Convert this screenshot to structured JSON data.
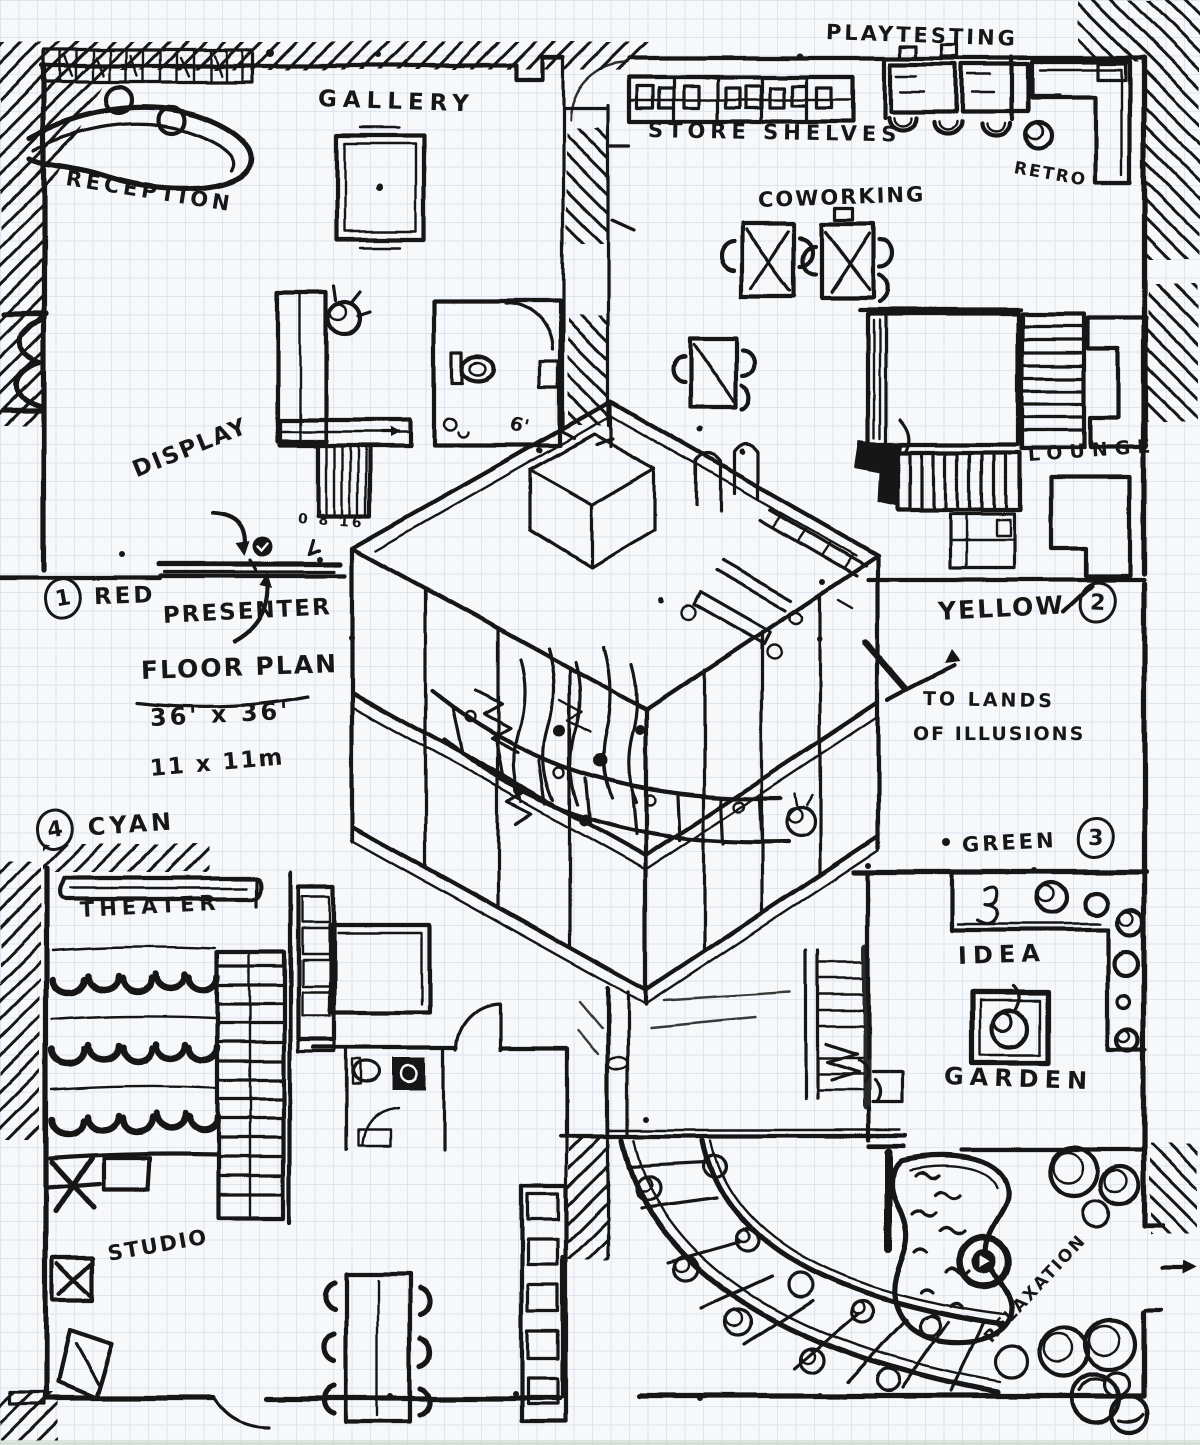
{
  "document": {
    "kind": "hand-drawn floor plan sketch",
    "media": "black ink on graph paper"
  },
  "plan": {
    "title": "FLOOR PLAN",
    "size_feet": "36' x 36'",
    "size_meters": "11 x 11m",
    "scale_bar": "0 8 16",
    "door_dimension": "6'"
  },
  "zones": [
    {
      "number": "1",
      "name": "RED"
    },
    {
      "number": "2",
      "name": "YELLOW"
    },
    {
      "number": "3",
      "name": "GREEN"
    },
    {
      "number": "4",
      "name": "CYAN"
    }
  ],
  "rooms": {
    "reception": "RECEPTION",
    "gallery": "GALLERY",
    "playtesting": "PLAYTESTING",
    "store_shelves": "STORE SHELVES",
    "coworking": "COWORKING",
    "retro": "RETRO",
    "lounge": "LOUNGE",
    "theater": "THEATER",
    "idea_garden_line1": "IDEA",
    "idea_garden_line2": "GARDEN",
    "studio": "STUDIO",
    "relaxation": "RELAXATION"
  },
  "annotations": {
    "display": "DISPLAY",
    "presenter": "PRESENTER",
    "exit_line1": "TO LANDS",
    "exit_line2": "OF ILLUSIONS"
  },
  "colors": {
    "paper": "#f7f8fa",
    "grid_line": "#dde5ee",
    "ink": "#171717"
  }
}
